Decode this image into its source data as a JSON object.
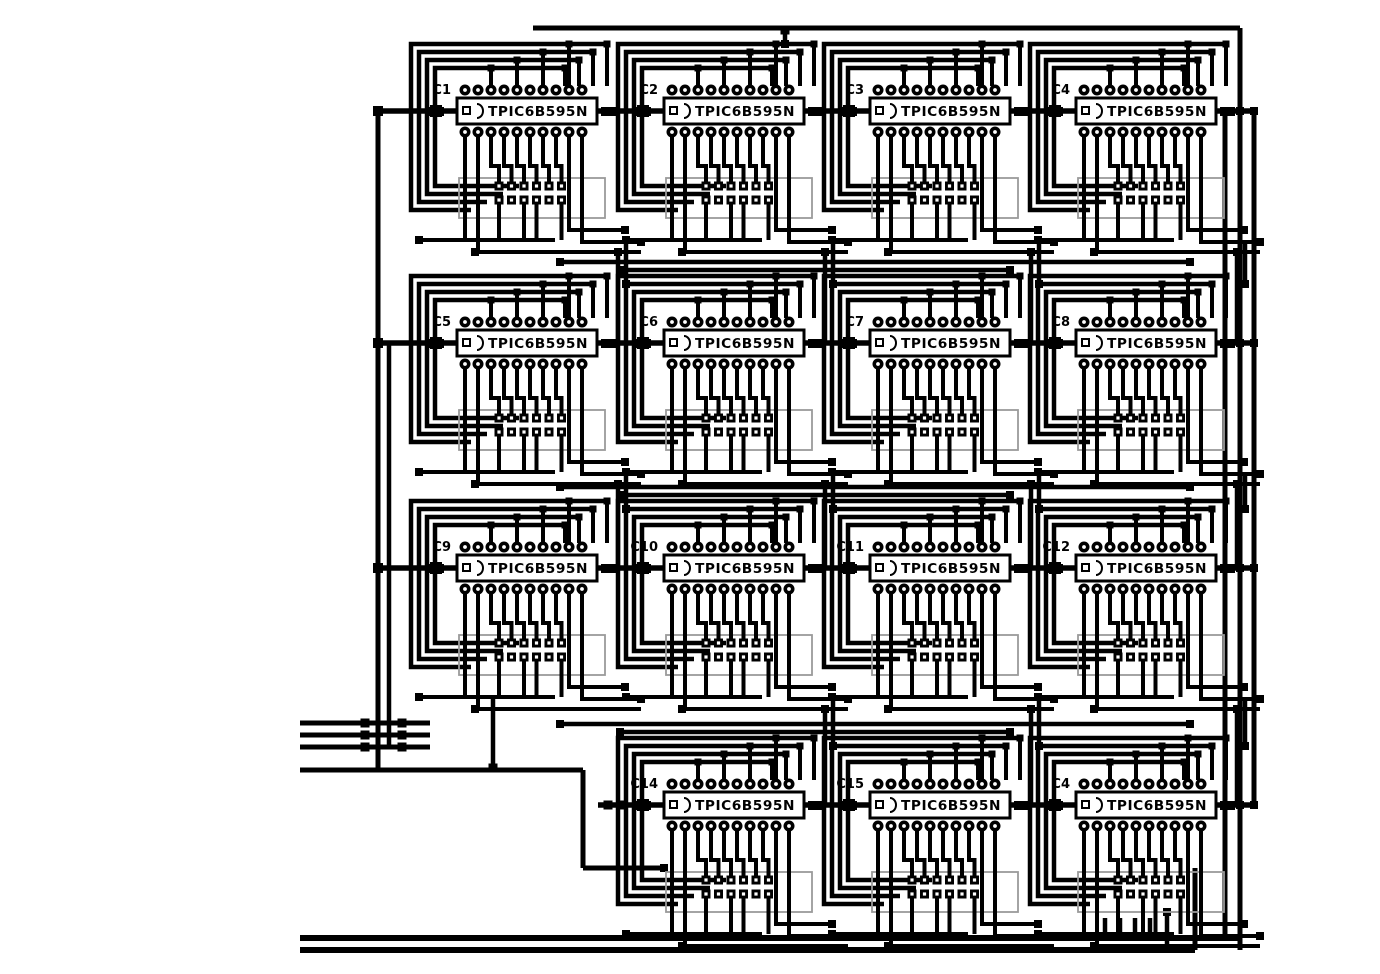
{
  "board": {
    "kind": "pcb-trace-layout",
    "description": "Black and white PCB routing layout of shift-register driver matrix",
    "part_number_text": "TPIC6B595N"
  },
  "colors": {
    "trace": "#000000",
    "background": "#ffffff",
    "pad_hole": "#ffffff",
    "silkscreen": "#9a9a9a"
  },
  "chips": [
    {
      "label": "C1",
      "part": "TPIC6B595N",
      "row": 0,
      "col": 0
    },
    {
      "label": "C2",
      "part": "TPIC6B595N",
      "row": 0,
      "col": 1
    },
    {
      "label": "C3",
      "part": "TPIC6B595N",
      "row": 0,
      "col": 2
    },
    {
      "label": "C4",
      "part": "TPIC6B595N",
      "row": 0,
      "col": 3
    },
    {
      "label": "C5",
      "part": "TPIC6B595N",
      "row": 1,
      "col": 0
    },
    {
      "label": "C6",
      "part": "TPIC6B595N",
      "row": 1,
      "col": 1
    },
    {
      "label": "C7",
      "part": "TPIC6B595N",
      "row": 1,
      "col": 2
    },
    {
      "label": "C8",
      "part": "TPIC6B595N",
      "row": 1,
      "col": 3
    },
    {
      "label": "C9",
      "part": "TPIC6B595N",
      "row": 2,
      "col": 0
    },
    {
      "label": "C10",
      "part": "TPIC6B595N",
      "row": 2,
      "col": 1
    },
    {
      "label": "C11",
      "part": "TPIC6B595N",
      "row": 2,
      "col": 2
    },
    {
      "label": "C12",
      "part": "TPIC6B595N",
      "row": 2,
      "col": 3
    },
    {
      "label": "C14",
      "part": "TPIC6B595N",
      "row": 3,
      "col": 1
    },
    {
      "label": "C15",
      "part": "TPIC6B595N",
      "row": 3,
      "col": 2
    },
    {
      "label": "C4",
      "part": "TPIC6B595N",
      "row": 3,
      "col": 3
    }
  ]
}
